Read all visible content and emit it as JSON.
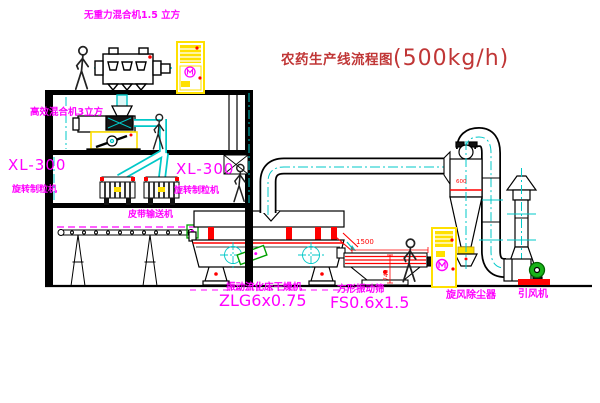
{
  "title": {
    "zh": "农药生产线流程图",
    "capacity": "(500kg/h)"
  },
  "labels": {
    "gravity_mixer": "无重力混合机1.5 立方",
    "high_eff_mixer": "高效混合机3立方",
    "granulator_left_model": "XL-300",
    "granulator_left_name": "旋转制粒机",
    "granulator_right_model": "XL-300",
    "granulator_right_name": "旋转制粒机",
    "belt_conveyor": "皮带输送机",
    "dryer_name": "振动流化床干燥机",
    "dryer_model": "ZLG6x0.75",
    "sieve_name": "方形振动筛",
    "sieve_model": "FS0.6x1.5",
    "cyclone": "旋风除尘器",
    "fan": "引风机"
  },
  "dimensions": {
    "sieve_length": "1500",
    "sieve_height": "740",
    "cyclone_note": "600"
  },
  "colors": {
    "magenta": "#FF00FF",
    "red": "#FF0000",
    "title_red": "#C03636",
    "cyan": "#00C8C8",
    "yellow": "#FFE000",
    "green": "#00A000",
    "line": "#000000",
    "background": "#FFFFFF"
  }
}
